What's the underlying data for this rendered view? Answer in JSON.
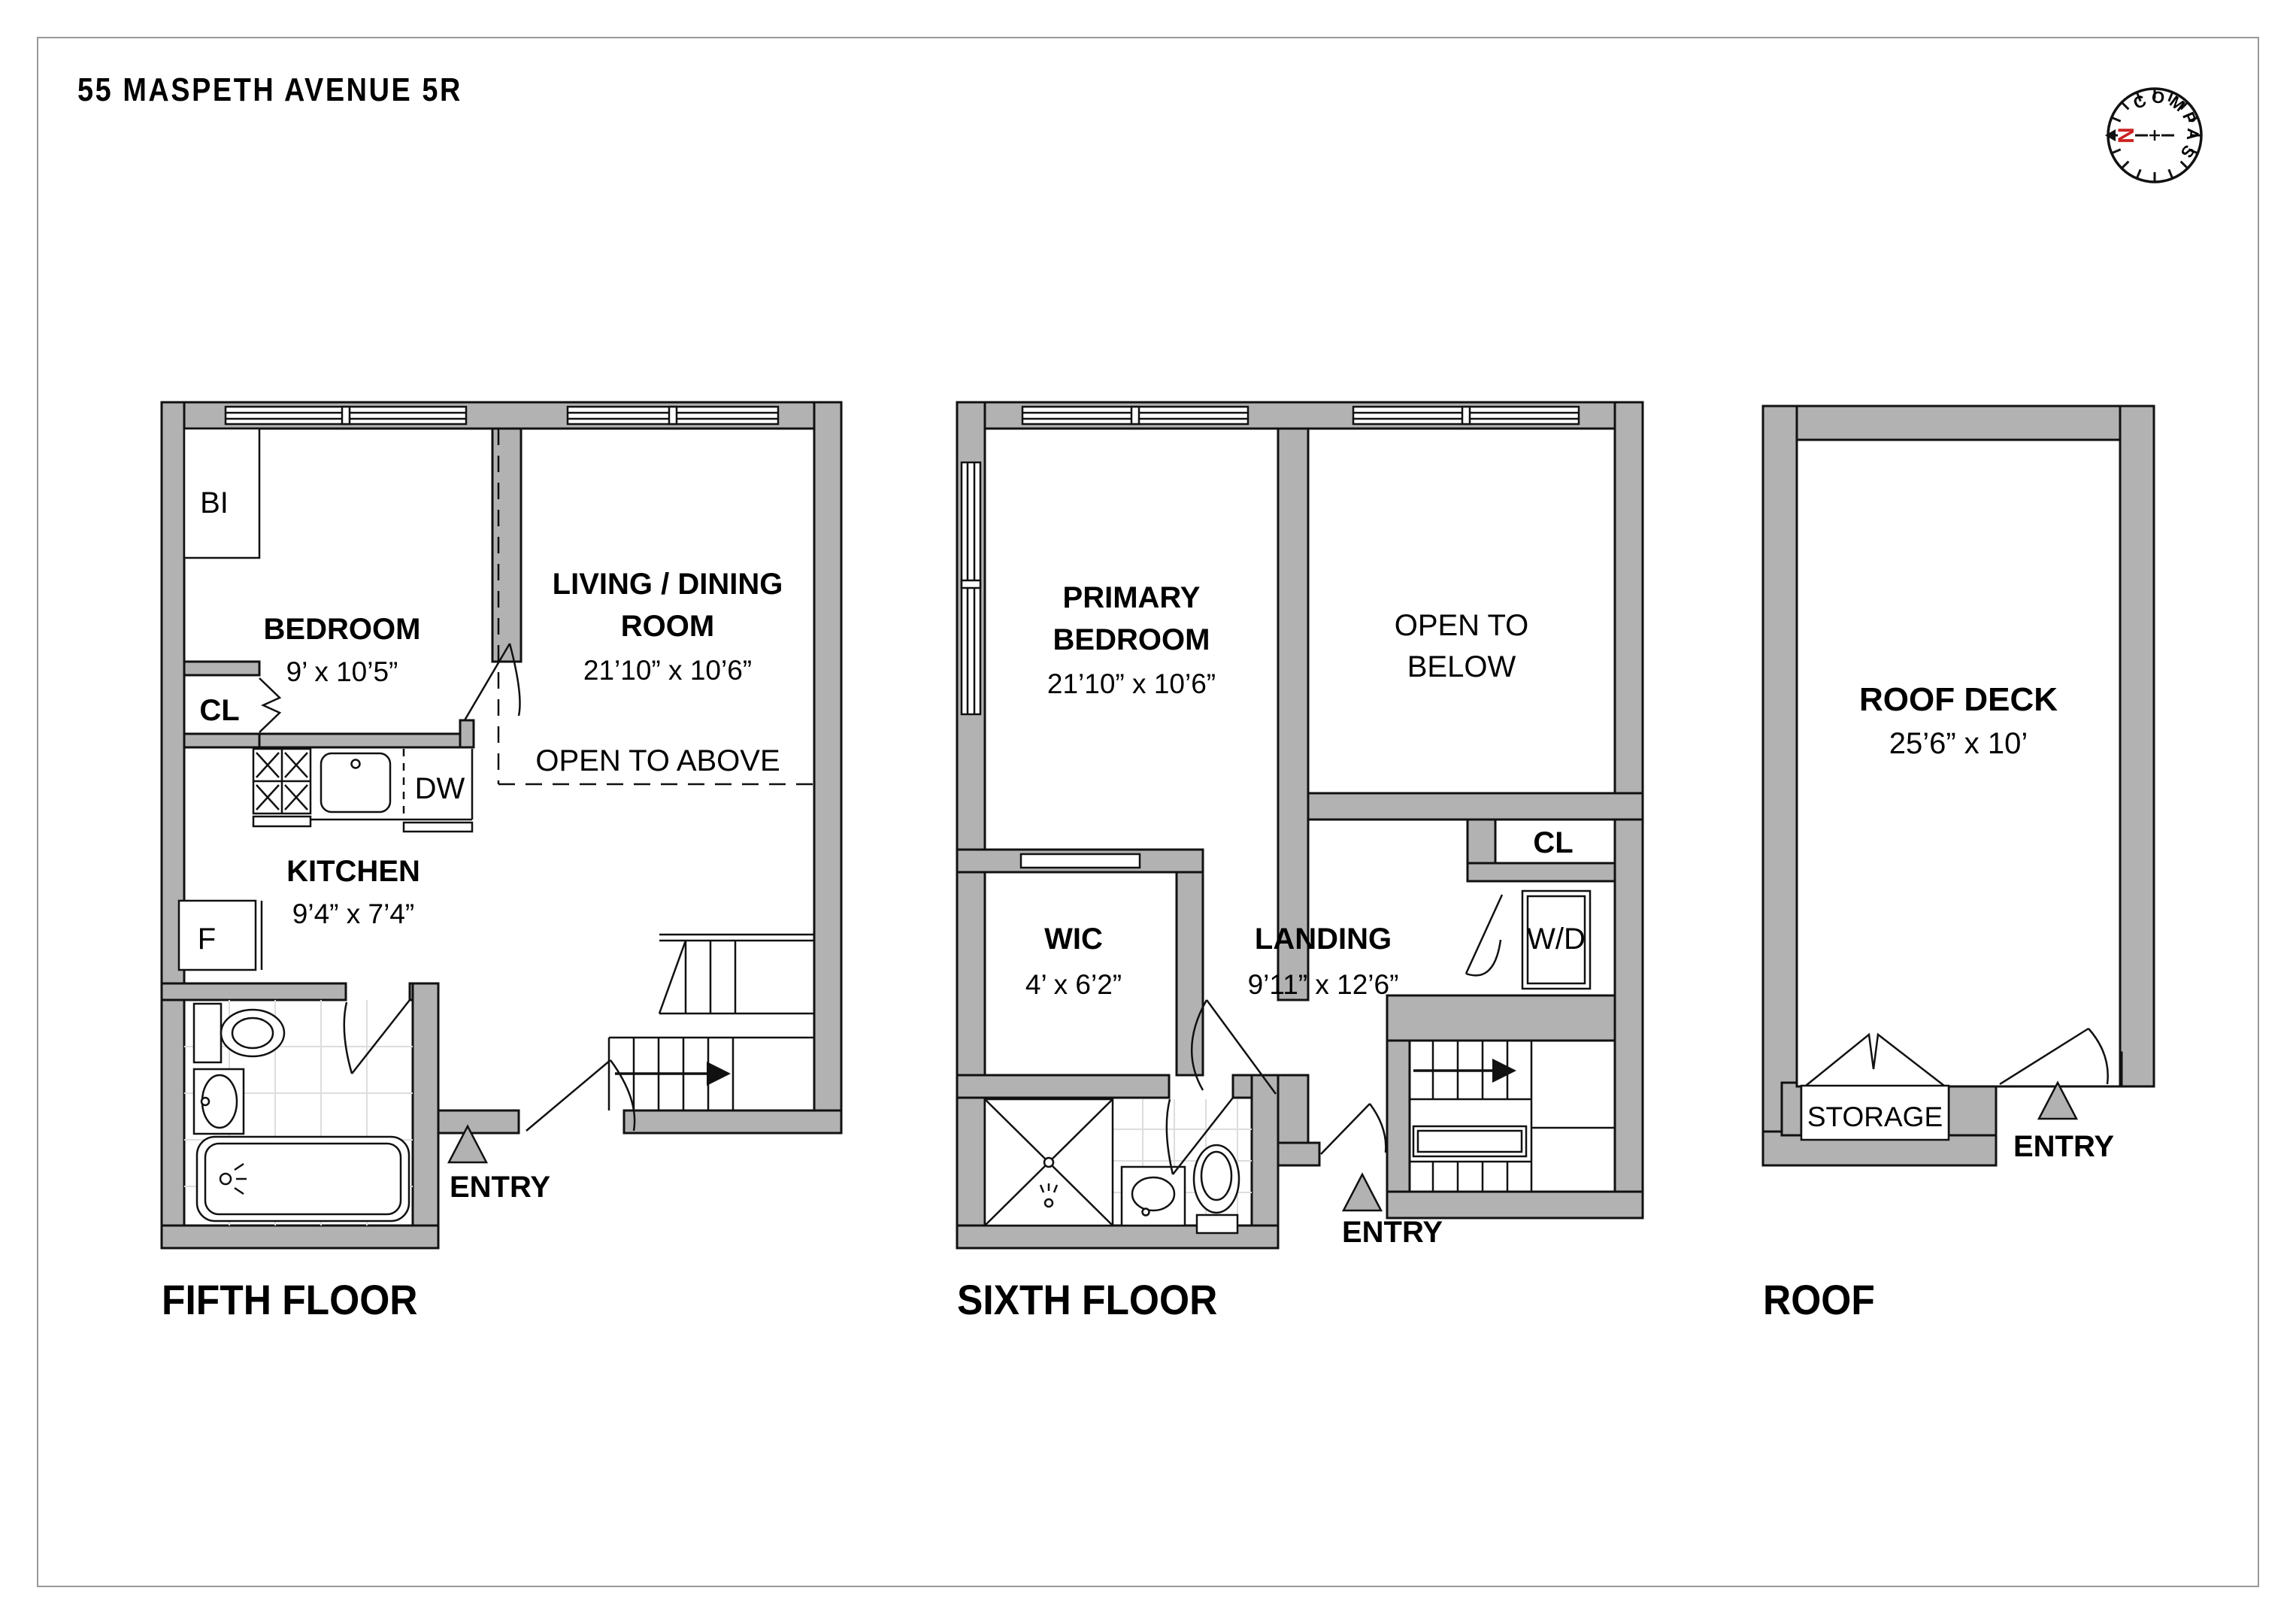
{
  "title": "55 MASPETH AVENUE 5R",
  "compass": {
    "label": "COMPASS",
    "north": "N",
    "accent_color": "#cc2222"
  },
  "colors": {
    "wall": "#b2b2b2",
    "line": "#111111",
    "tile": "#dddddd"
  },
  "floors": {
    "fifth": {
      "label": "FIFTH FLOOR",
      "bi_closet": "BI",
      "bedroom": {
        "name": "BEDROOM",
        "dims": "9’ x 10’5”"
      },
      "living": {
        "line1": "LIVING / DINING",
        "line2": "ROOM",
        "dims": "21’10” x 10’6”"
      },
      "open_to_above": "OPEN TO ABOVE",
      "closet": "CL",
      "kitchen": {
        "name": "KITCHEN",
        "dims": "9’4” x 7’4”",
        "dishwasher": "DW",
        "fridge": "F"
      },
      "entry": "ENTRY"
    },
    "sixth": {
      "label": "SIXTH FLOOR",
      "primary_bedroom": {
        "line1": "PRIMARY",
        "line2": "BEDROOM",
        "dims": "21’10” x 10’6”"
      },
      "open_to_below": {
        "line1": "OPEN TO",
        "line2": "BELOW"
      },
      "closet": "CL",
      "washer_dryer": "W/D",
      "wic": {
        "name": "WIC",
        "dims": "4’ x 6’2”"
      },
      "landing": {
        "name": "LANDING",
        "dims": "9’11” x 12’6”"
      },
      "entry": "ENTRY"
    },
    "roof": {
      "label": "ROOF",
      "deck": {
        "name": "ROOF DECK",
        "dims": "25’6” x 10’"
      },
      "storage": "STORAGE",
      "entry": "ENTRY"
    }
  }
}
